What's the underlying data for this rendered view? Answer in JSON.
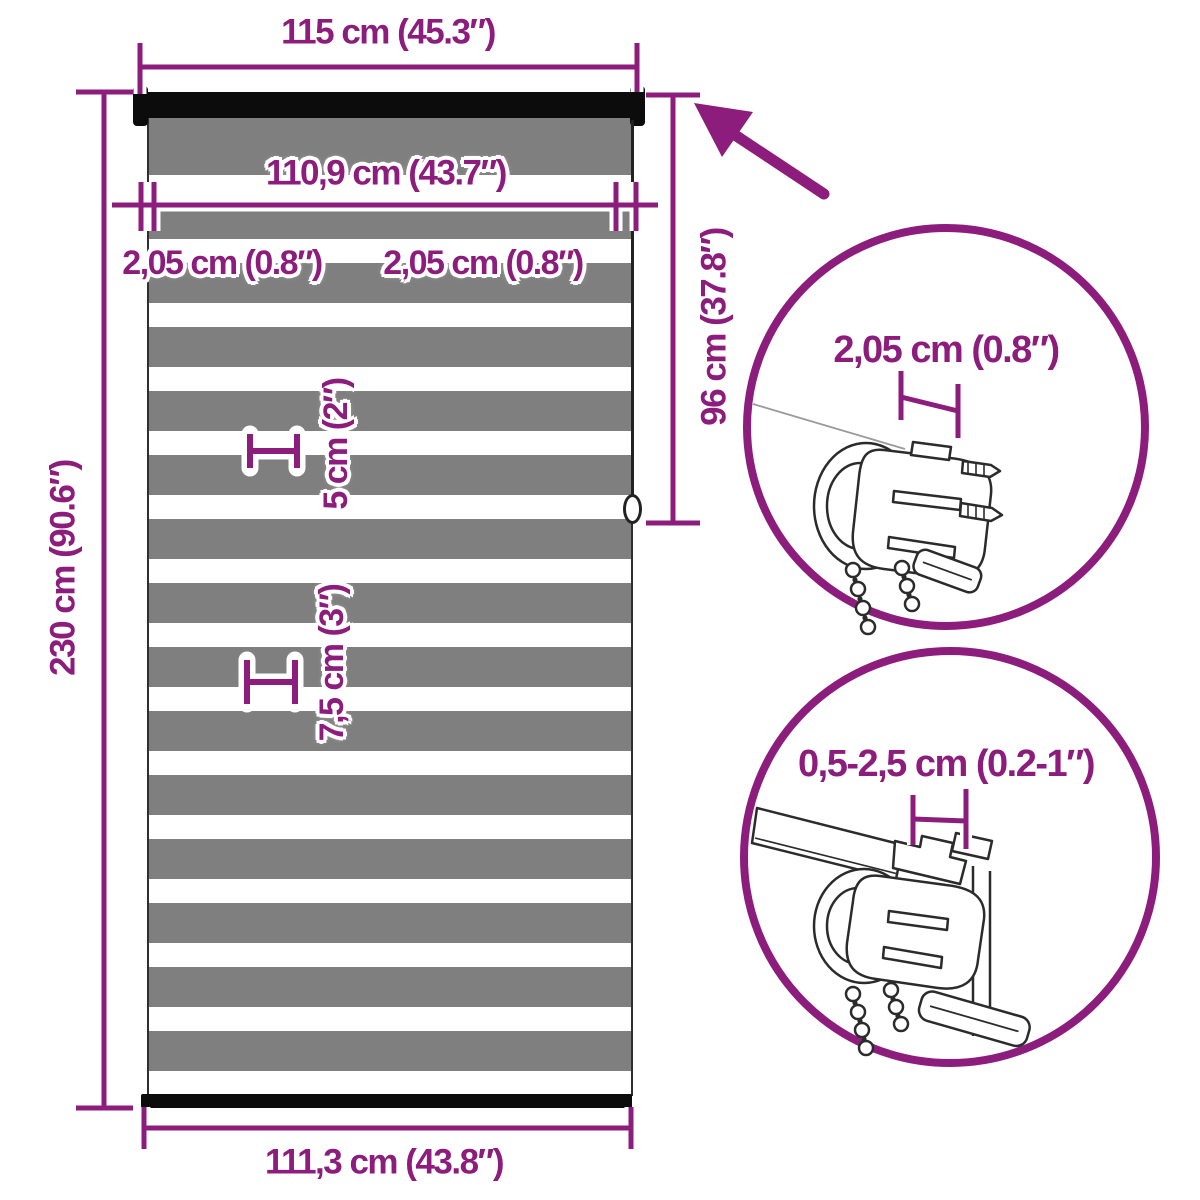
{
  "colors": {
    "accent_purple": "#8c1d7c",
    "stripe_gray": "#7f7f7f",
    "rail_black": "#0c0c0c",
    "lineart_dark": "#2b2b2b"
  },
  "blind": {
    "top_width": "115 cm (45.3″)",
    "inner_width": "110,9 cm (43.7″)",
    "offset_left": "2,05 cm (0.8″)",
    "offset_right": "2,05 cm (0.8″)",
    "total_height": "230 cm (90.6″)",
    "drop_height": "96 cm (37.8″)",
    "stripe_small": "5 cm (2″)",
    "stripe_large": "7,5 cm (3″)",
    "bottom_width": "111,3 cm (43.8″)"
  },
  "callouts": {
    "top_bracket_width": "2,05 cm (0.8″)",
    "mount_depth_range": "0,5-2,5 cm (0.2-1″)"
  }
}
